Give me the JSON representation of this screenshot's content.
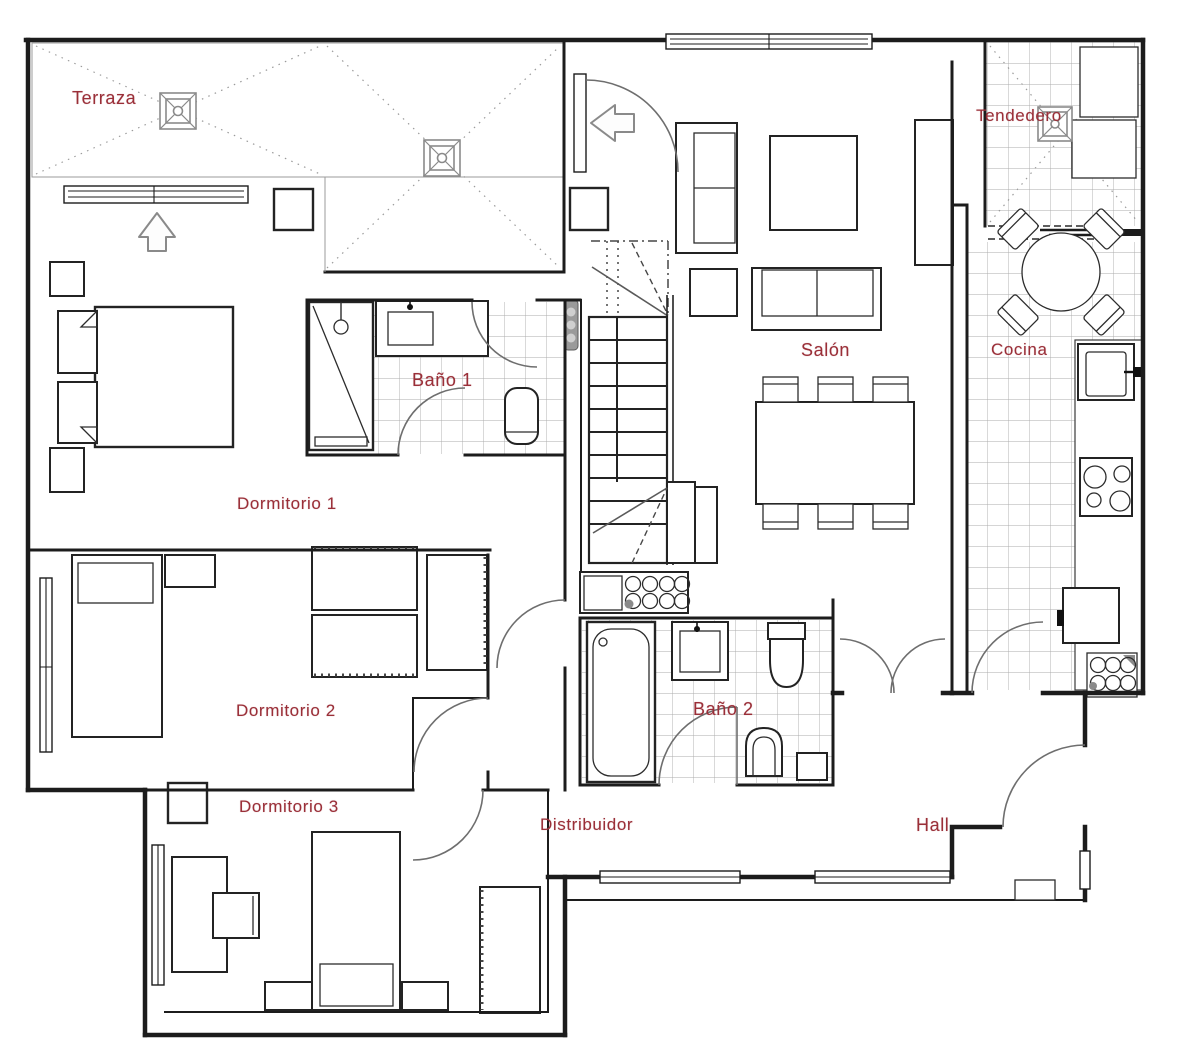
{
  "document": {
    "type": "floor-plan",
    "language": "es"
  },
  "colors": {
    "walls": "#1c1c1c",
    "labels": "#9a2f38",
    "pattern": "#a8a8a8",
    "arrow": "#8a8a8a"
  },
  "icons": {
    "floor_drain": "square-with-x",
    "entry_arrow_up": "outline-arrow-up",
    "entry_arrow_left": "outline-arrow-left",
    "stairs": "tread-lines-with-break",
    "door": "quarter-circle-swing",
    "sliding_door": "dashed-offset-panels"
  },
  "rooms": {
    "terraza": {
      "label": "Terraza"
    },
    "tendedero": {
      "label": "Tendedero"
    },
    "salon": {
      "label": "Salón"
    },
    "cocina": {
      "label": "Cocina"
    },
    "bano1": {
      "label": "Baño 1"
    },
    "dormitorio1": {
      "label": "Dormitorio 1"
    },
    "dormitorio2": {
      "label": "Dormitorio 2"
    },
    "dormitorio3": {
      "label": "Dormitorio 3"
    },
    "bano2": {
      "label": "Baño 2"
    },
    "distribuidor": {
      "label": "Distribuidor"
    },
    "hall": {
      "label": "Hall"
    }
  }
}
